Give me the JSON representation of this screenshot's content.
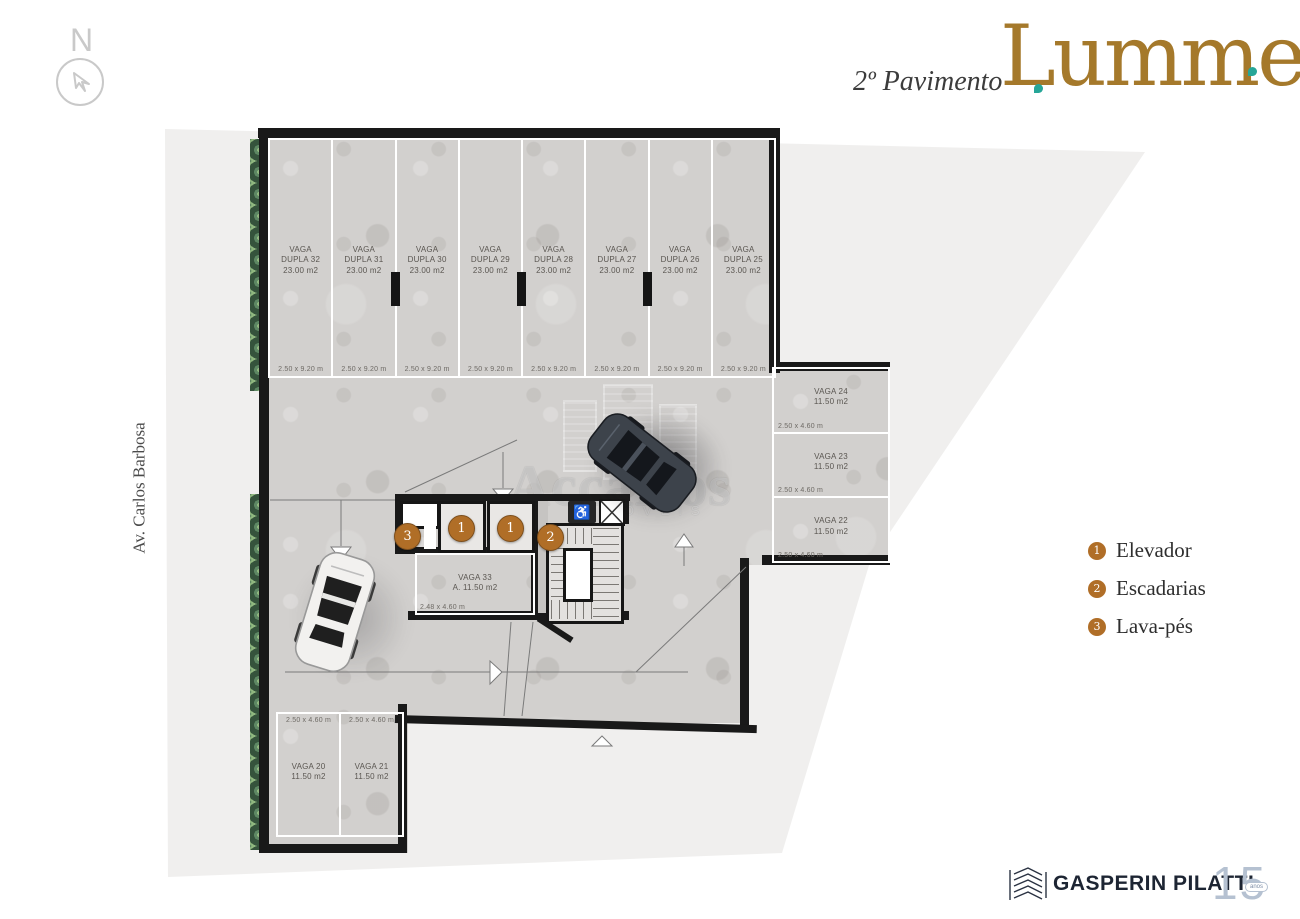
{
  "header": {
    "floor_label": "2º Pavimento",
    "brand": "Lumme"
  },
  "north": {
    "label": "N"
  },
  "street": {
    "label": "Av. Carlos Barbosa"
  },
  "watermark": {
    "title": "Accarlos",
    "subtitle": "IMÓVEIS"
  },
  "markers": {
    "m1": "1",
    "m2": "2",
    "m3": "3"
  },
  "legend": {
    "items": [
      {
        "num": "1",
        "label": "Elevador"
      },
      {
        "num": "2",
        "label": "Escadarias"
      },
      {
        "num": "3",
        "label": "Lava-pés"
      }
    ]
  },
  "stalls": {
    "top_row": [
      {
        "line1": "VAGA",
        "line2": "DUPLA 32",
        "area": "23.00 m2",
        "dim": "2.50 x 9.20 m"
      },
      {
        "line1": "VAGA",
        "line2": "DUPLA 31",
        "area": "23.00 m2",
        "dim": "2.50 x 9.20 m"
      },
      {
        "line1": "VAGA",
        "line2": "DUPLA 30",
        "area": "23.00 m2",
        "dim": "2.50 x 9.20 m"
      },
      {
        "line1": "VAGA",
        "line2": "DUPLA 29",
        "area": "23.00 m2",
        "dim": "2.50 x 9.20 m"
      },
      {
        "line1": "VAGA",
        "line2": "DUPLA 28",
        "area": "23.00 m2",
        "dim": "2.50 x 9.20 m"
      },
      {
        "line1": "VAGA",
        "line2": "DUPLA 27",
        "area": "23.00 m2",
        "dim": "2.50 x 9.20 m"
      },
      {
        "line1": "VAGA",
        "line2": "DUPLA 26",
        "area": "23.00 m2",
        "dim": "2.50 x 9.20 m"
      },
      {
        "line1": "VAGA",
        "line2": "DUPLA 25",
        "area": "23.00 m2",
        "dim": "2.50 x 9.20 m"
      }
    ],
    "right_column": [
      {
        "name": "VAGA 24",
        "area": "11.50 m2",
        "dim": "2.50 x 4.60 m"
      },
      {
        "name": "VAGA 23",
        "area": "11.50 m2",
        "dim": "2.50 x 4.60 m"
      },
      {
        "name": "VAGA 22",
        "area": "11.50 m2",
        "dim": "2.50 x 4.60 m"
      }
    ],
    "bottom_row": [
      {
        "name": "VAGA 20",
        "area": "11.50 m2",
        "dim": "2.50 x 4.60 m"
      },
      {
        "name": "VAGA 21",
        "area": "11.50 m2",
        "dim": "2.50 x 4.60 m"
      }
    ],
    "center_stall": {
      "name": "VAGA 33",
      "area": "A. 11.50 m2",
      "dim": "2.48 x 4.60 m"
    }
  },
  "footer": {
    "company": "GASPERIN PILATTI",
    "years": "15",
    "years_label": "anos"
  },
  "colors": {
    "brand_gold": "#a5792b",
    "accent_teal": "#26a698",
    "marker_orange": "#b06e27",
    "wall_black": "#191919"
  }
}
